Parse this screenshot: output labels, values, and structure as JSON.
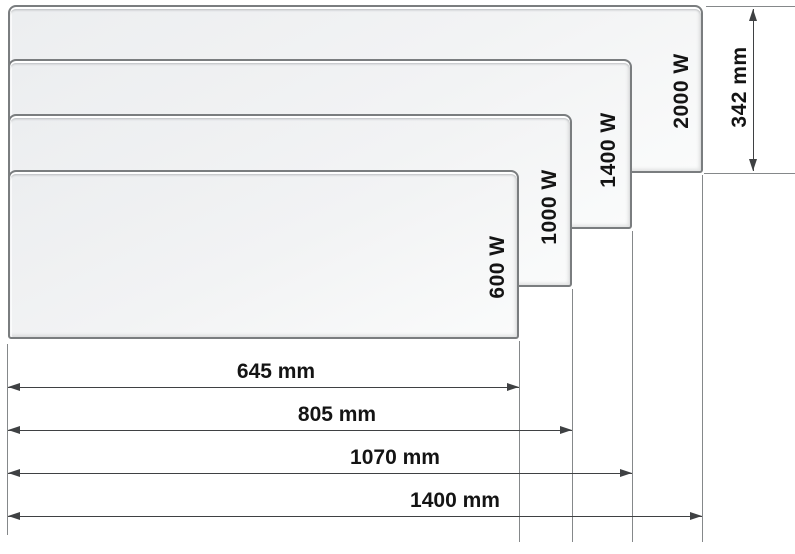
{
  "diagram": {
    "panels": [
      {
        "power_label": "600 W",
        "width_label": "645 mm"
      },
      {
        "power_label": "1000 W",
        "width_label": "805 mm"
      },
      {
        "power_label": "1400 W",
        "width_label": "1070 mm"
      },
      {
        "power_label": "2000 W",
        "width_label": "1400 mm"
      }
    ],
    "height_label": "342 mm",
    "colors": {
      "background": "#ffffff",
      "panel_fill": "#f0f1f2",
      "panel_border": "#7a7d7f",
      "dimension_line": "#3f4143",
      "extension_line": "#85888a",
      "text": "#141414"
    }
  }
}
